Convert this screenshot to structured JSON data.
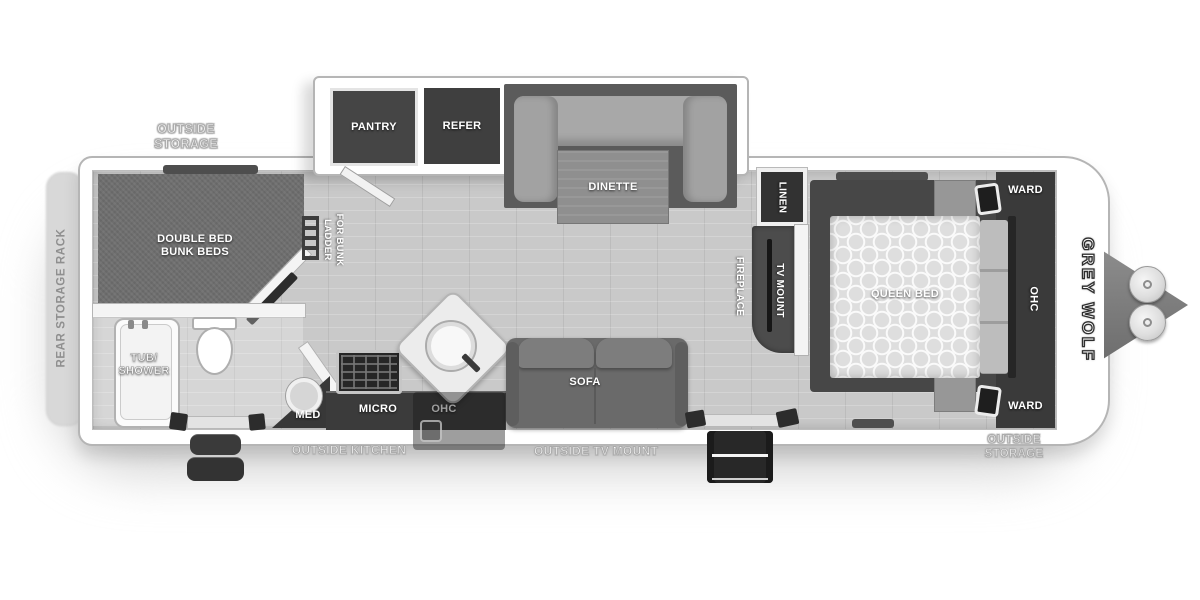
{
  "meta": {
    "type": "travel trailer floor plan",
    "brand_logo": "GREY WOLF"
  },
  "colors": {
    "floor": "#c9c9c9",
    "carpet": "#6e6e6e",
    "cabinet_dark": "#3b3b3b",
    "slide_dark": "#5b5b5b",
    "cushion": "#a8a8a8",
    "sofa": "#6a6a6a",
    "wall": "#f4f4f4",
    "label_white": "#ffffff",
    "outline_gray": "#ababab"
  },
  "labels": {
    "rear_storage_rack": "REAR STORAGE RACK",
    "outside_storage_rear": "OUTSIDE\nSTORAGE",
    "bunk_room": "DOUBLE BED\nBUNK BEDS",
    "ladder_line1": "LADDER",
    "ladder_line2": "FOR BUNK",
    "pantry": "PANTRY",
    "refer": "REFER",
    "dinette": "DINETTE",
    "linen": "LINEN",
    "tub_shower": "TUB/\nSHOWER",
    "med": "MED",
    "micro": "MICRO",
    "ohc_kitchen": "OHC",
    "outside_kitchen": "OUTSIDE KITCHEN",
    "sofa": "SOFA",
    "outside_tv_mount": "OUTSIDE TV MOUNT",
    "fireplace": "FIREPLACE",
    "tv_mount_living": "TV MOUNT",
    "tv_mount_bedroom": "TV MOUNT",
    "queen_bed": "QUEEN BED",
    "ward_top": "WARD",
    "ward_bottom": "WARD",
    "ohc_bedroom": "OHC",
    "outside_storage_front": "OUTSIDE\nSTORAGE",
    "brand_logo": "GREY WOLF"
  }
}
